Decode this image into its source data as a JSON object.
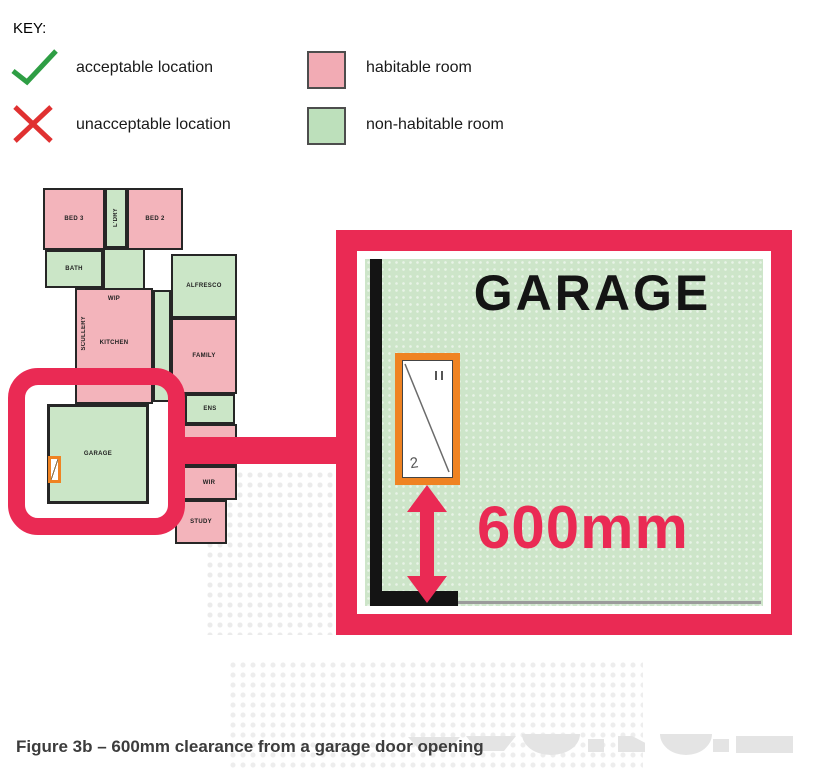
{
  "key": {
    "title": "KEY:",
    "acceptable_label": "acceptable location",
    "unacceptable_label": "unacceptable location",
    "habitable_label": "habitable room",
    "non_habitable_label": "non-habitable room"
  },
  "floorplan": {
    "rooms": [
      {
        "label": "BED 3",
        "type": "habitable"
      },
      {
        "label": "L'DRY",
        "type": "non-habitable"
      },
      {
        "label": "BED 2",
        "type": "habitable"
      },
      {
        "label": "BATH",
        "type": "non-habitable"
      },
      {
        "label": "ALFRESCO",
        "type": "non-habitable"
      },
      {
        "label": "WIP",
        "type": "habitable"
      },
      {
        "label": "SCULLERY",
        "type": "habitable"
      },
      {
        "label": "KITCHEN",
        "type": "habitable"
      },
      {
        "label": "FAMILY",
        "type": "habitable"
      },
      {
        "label": "ENS",
        "type": "non-habitable"
      },
      {
        "label": "WIR",
        "type": "habitable"
      },
      {
        "label": "STUDY",
        "type": "habitable"
      },
      {
        "label": "GARAGE",
        "type": "non-habitable"
      }
    ]
  },
  "detail": {
    "room_label": "GARAGE",
    "clearance_label": "600mm",
    "door_tag": "2"
  },
  "caption": "Figure 3b – 600mm clearance from a garage door opening",
  "colors": {
    "highlight_crimson": "#EA2A54",
    "habitable_pink": "#F3B4BB",
    "non_habitable_green": "#CBE6C7",
    "detail_green": "#CDE5C9",
    "door_frame_orange": "#EF8322",
    "check_green": "#2E9E44",
    "cross_red": "#E03131",
    "wall_black": "#141414"
  }
}
